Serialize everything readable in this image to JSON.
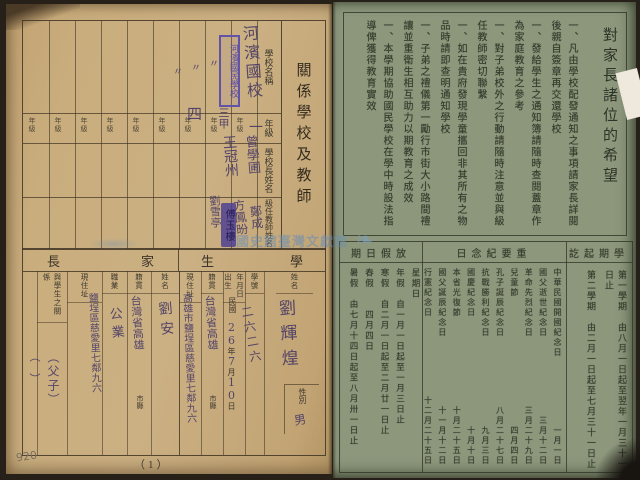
{
  "page": {
    "watermark_text": "國史館臺灣文獻館",
    "page_number": "（1）",
    "pencil_note": "920"
  },
  "left_page": {
    "school_table": {
      "title": "關係學校及教師",
      "headers": {
        "school": "學校名稱",
        "grade": "年級",
        "principal": "學校長姓名",
        "teacher": "級任教師姓名"
      },
      "grade_cell_label": "年級",
      "school_stamp": "河濱國民學校",
      "name_seal": "傅玉樓",
      "handwriting": {
        "school_name": "河濱國校",
        "ditto_1": "〃",
        "ditto_2": "〃",
        "ditto_3": "〃",
        "grade_1": "一",
        "grade_2": "三甲",
        "grade_3": "四",
        "principal_1": "曾學圃",
        "teacher_1": "鄭成",
        "principal_2": "王冠州",
        "teacher_2": "方鳳昐",
        "teacher_3": "劉雪亭"
      }
    },
    "form": {
      "student_section_label_1": "學",
      "student_section_label_2": "生",
      "parent_section_label_1": "家",
      "parent_section_label_2": "長",
      "student_headers": {
        "name": "姓名",
        "sex": "性別",
        "number": "學號",
        "birth_a": "出生",
        "birth_b": "年月日",
        "era": "民國",
        "year_label": "年",
        "month_label": "月",
        "day_label": "日",
        "origin": "籍貫",
        "origin_suffix": "市縣",
        "address": "現住址"
      },
      "student_values": {
        "name": "劉輝煌",
        "sex": "男",
        "number": "二六二六",
        "birth_year": "26",
        "birth_month": "7",
        "birth_day": "10",
        "origin": "台灣省高雄",
        "address": "高雄市鹽埕區慈愛里七鄰九六"
      },
      "parent_headers": {
        "name": "姓名",
        "origin": "籍貫",
        "origin_suffix": "市縣",
        "occupation": "職業",
        "address": "現住址",
        "relation": "與學生之關係",
        "remarks": "備考"
      },
      "parent_values": {
        "name": "劉安",
        "origin": "台灣省高雄",
        "occupation": "公業",
        "address": "鹽埕區慈愛里七鄰九六",
        "relation": "（父子）",
        "remarks": "（　）"
      }
    }
  },
  "right_page": {
    "hopes": {
      "title": "對家長諸位的希望",
      "bullet": "一、",
      "items": [
        "凡由學校配發通知之事項請家長詳閱後親自簽章再交還學校",
        "發給學生之通知簿請隨時查閱蓋章作為家庭教育之參考",
        "對子弟校外之行動請隨時注意並與級任教師密切聯繫",
        "如在貴府發現學童攜回非其所有之物品時請即查明通知學校",
        "子弟之禮儀第一勵行市街大小路間禮讓並重衛生相互助力以期教育之成效",
        "本學期協助國民學校在學中時設法指導俾獲得教育實效"
      ]
    },
    "calendar": {
      "term_section": {
        "header": "學期起訖",
        "header_display": "訖起期學",
        "terms": [
          "第一學期　由八月一日起至翌年一月三十一日止",
          "第二學期　由二月一日起至七月三十一日止"
        ]
      },
      "days_section": {
        "header": "重要紀念日",
        "header_display": "日念紀要重",
        "days": [
          {
            "name": "中華民國開國紀念日",
            "date": "一月一日"
          },
          {
            "name": "國父逝世紀念日",
            "date": "三月十二日"
          },
          {
            "name": "革命先烈紀念日",
            "date": "三月二十九日"
          },
          {
            "name": "兒童節",
            "date": "四月四日"
          },
          {
            "name": "孔子誕辰紀念日",
            "date": "八月二十七日"
          },
          {
            "name": "抗戰勝利紀念日",
            "date": "九月三日"
          },
          {
            "name": "國慶紀念日",
            "date": "十月十日"
          },
          {
            "name": "本省光復節",
            "date": "十月二十五日"
          },
          {
            "name": "國父誕辰紀念日",
            "date": "十一月十二日"
          },
          {
            "name": "行憲紀念日",
            "date": "十二月二十五日"
          }
        ]
      },
      "holiday_section": {
        "header": "放假日期",
        "header_display": "期日假放",
        "holidays": [
          "星期日",
          "年假　自一月一日起至一月三日止",
          "寒假　自二月一日起至二月廿一日止",
          "春假　　四月四日",
          "暑假　由七月十四日起至八月卅一日止"
        ]
      }
    }
  }
}
